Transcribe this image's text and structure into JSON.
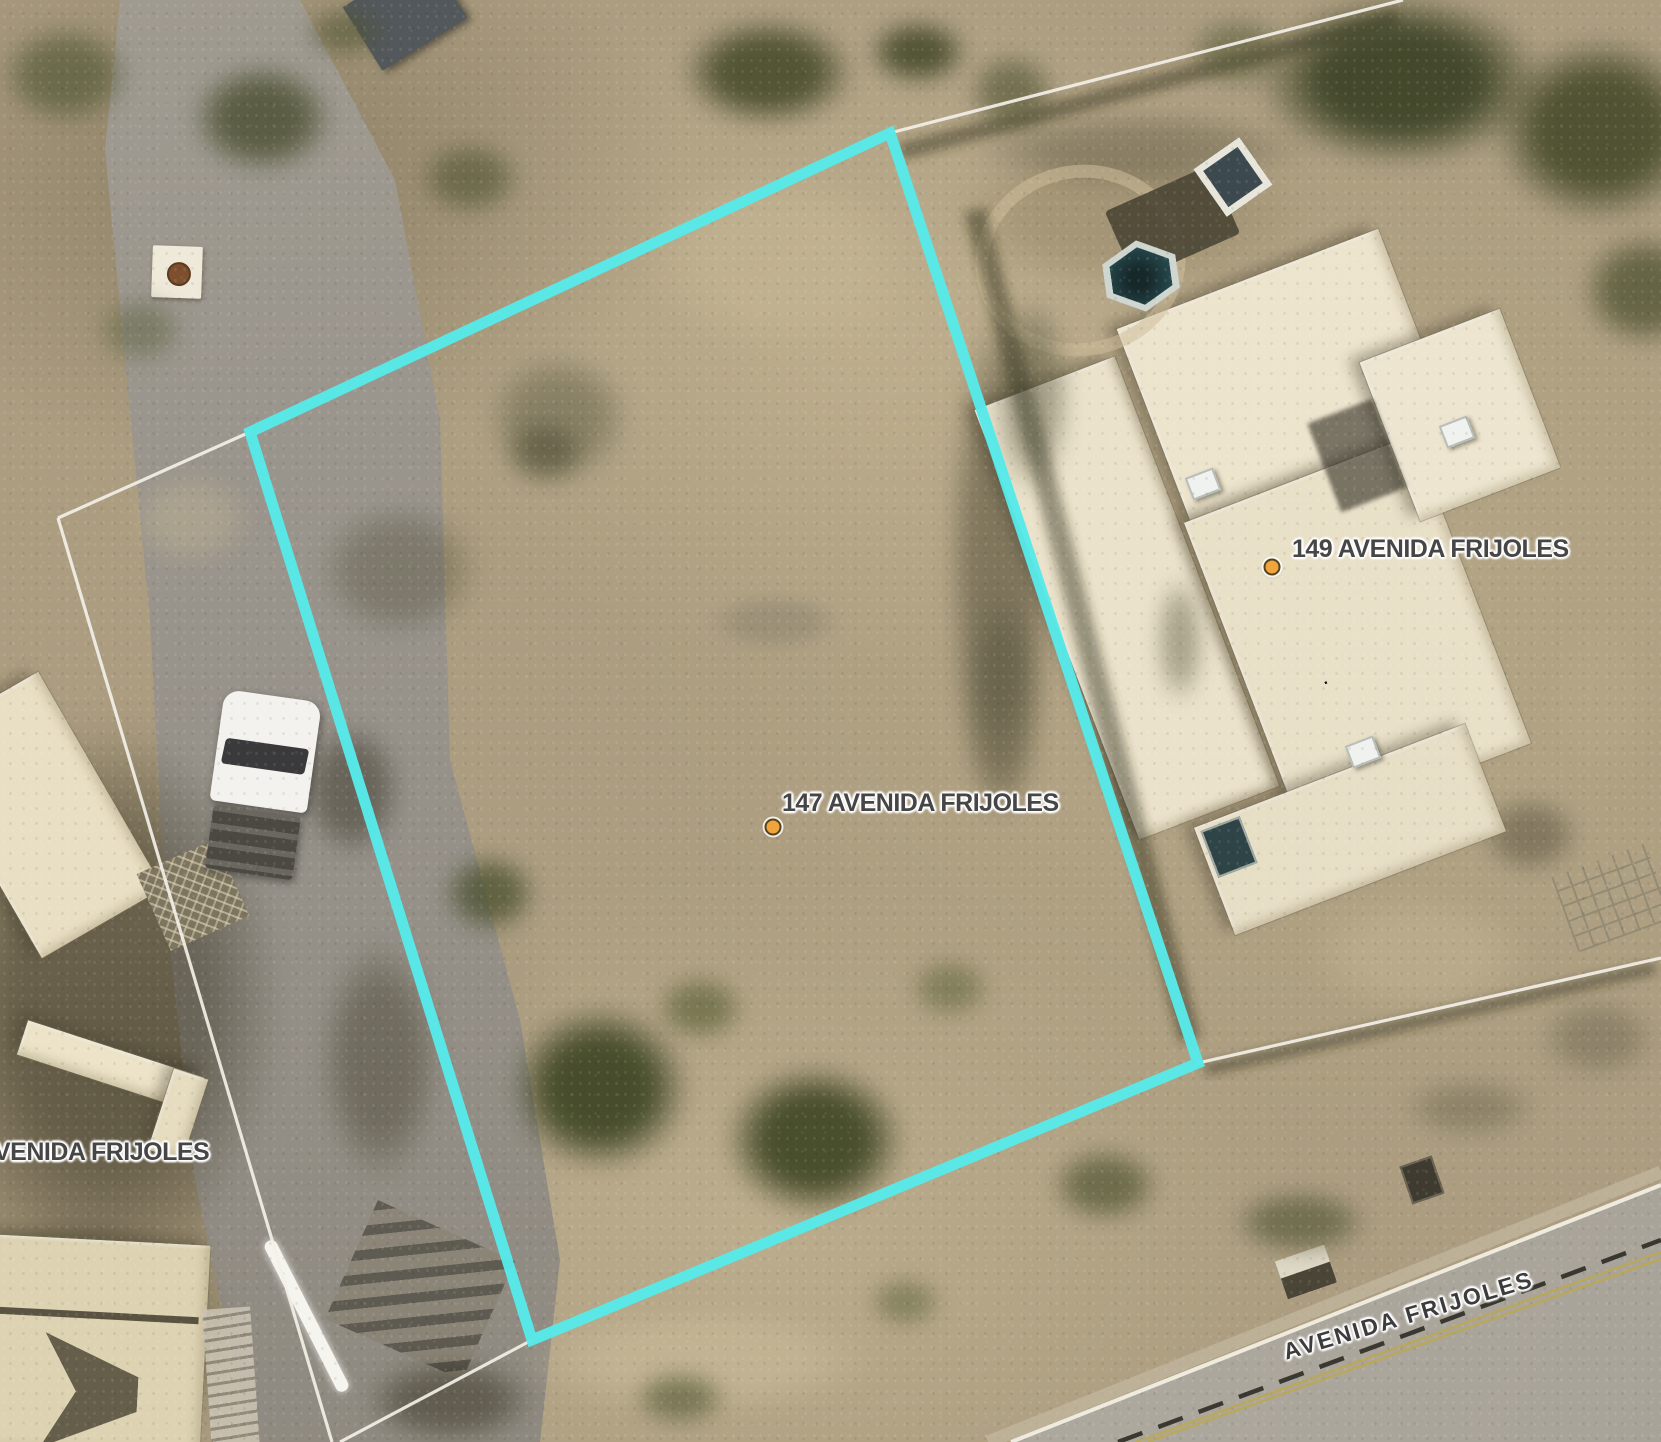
{
  "map": {
    "address_labels": [
      {
        "id": "parcel147",
        "text": "147 AVENIDA FRIJOLES"
      },
      {
        "id": "parcel149",
        "text": "149 AVENIDA FRIJOLES"
      }
    ],
    "street_label": {
      "text": "AVENIDA FRIJOLES"
    },
    "street_label_partial": {
      "text": "VENIDA FRIJOLES"
    }
  },
  "colors": {
    "parcel_highlight": "#57e9e9",
    "parcel_line": "#f3f0e8",
    "label_text": "#464646",
    "street_label_text": "#3c3c3c",
    "label_halo": "#ffffff",
    "marker_fill": "#efa43c",
    "marker_ring": "#55431f",
    "road_dash": "#26241d",
    "road_yellow": "#c1a83e",
    "road_edge_white": "#f2eee2",
    "shoulder": "#c6bda7"
  },
  "geometry": {
    "highlight_polygon": "890,133 250,432 532,1340 1198,1063",
    "parcel_lines": [
      {
        "x1": 890,
        "y1": 133,
        "x2": 1403,
        "y2": 0
      },
      {
        "x1": 250,
        "y1": 432,
        "x2": 58,
        "y2": 518
      },
      {
        "x1": 58,
        "y1": 518,
        "x2": 332,
        "y2": 1442
      },
      {
        "x1": 532,
        "y1": 1340,
        "x2": 340,
        "y2": 1442
      },
      {
        "x1": 1198,
        "y1": 1063,
        "x2": 1661,
        "y2": 958
      }
    ],
    "road_shoulder": {
      "x1": 988,
      "y1": 1442,
      "x2": 1661,
      "y2": 1172
    },
    "road_edge": {
      "x1": 1011,
      "y1": 1442,
      "x2": 1661,
      "y2": 1185
    },
    "road_centerline": {
      "x1": 1118,
      "y1": 1442,
      "x2": 1661,
      "y2": 1240
    },
    "road_yellow_a": {
      "x1": 1136,
      "y1": 1442,
      "x2": 1661,
      "y2": 1252
    },
    "road_yellow_b": {
      "x1": 1148,
      "y1": 1442,
      "x2": 1661,
      "y2": 1259
    },
    "markers": [
      {
        "x": 773,
        "y": 827
      },
      {
        "x": 1272,
        "y": 567
      }
    ]
  },
  "ground_patches": [
    {
      "x": 1130,
      "y": 215,
      "rx": 260,
      "ry": 110,
      "c": "#9a8b6c",
      "o": 0.6
    },
    {
      "x": 780,
      "y": 260,
      "rx": 190,
      "ry": 130,
      "c": "#c6b795",
      "o": 0.55
    },
    {
      "x": 1420,
      "y": 955,
      "rx": 160,
      "ry": 85,
      "c": "#c2b593",
      "o": 0.5
    },
    {
      "x": 700,
      "y": 1360,
      "rx": 250,
      "ry": 75,
      "c": "#cbbd9c",
      "o": 0.55
    },
    {
      "x": 190,
      "y": 520,
      "rx": 85,
      "ry": 65,
      "c": "#c0b291",
      "o": 0.45
    },
    {
      "x": 1240,
      "y": 150,
      "rx": 95,
      "ry": 65,
      "c": "#b3a483",
      "o": 0.55
    },
    {
      "x": 400,
      "y": 570,
      "rx": 115,
      "ry": 95,
      "c": "#55513c",
      "o": 0.4
    },
    {
      "x": 775,
      "y": 622,
      "rx": 95,
      "ry": 40,
      "c": "#8d8570",
      "o": 0.55,
      "b": 6
    },
    {
      "x": 380,
      "y": 1060,
      "rx": 85,
      "ry": 170,
      "c": "#46422f",
      "o": 0.45
    },
    {
      "x": 352,
      "y": 790,
      "rx": 70,
      "ry": 95,
      "c": "#3b382b",
      "o": 0.5
    },
    {
      "x": 110,
      "y": 1000,
      "rx": 240,
      "ry": 380,
      "c": "#403c2b",
      "o": 0.5
    },
    {
      "x": 80,
      "y": 1340,
      "rx": 210,
      "ry": 170,
      "c": "#34311f",
      "o": 0.55
    },
    {
      "x": 1000,
      "y": 560,
      "rx": 75,
      "ry": 360,
      "c": "#4a4733",
      "o": 0.5
    },
    {
      "x": 1470,
      "y": 1108,
      "rx": 95,
      "ry": 42,
      "c": "#6b654f",
      "o": 0.45
    },
    {
      "x": 1530,
      "y": 835,
      "rx": 70,
      "ry": 55,
      "c": "#55503c",
      "o": 0.5
    },
    {
      "x": 1140,
      "y": 150,
      "rx": 240,
      "ry": 55,
      "c": "#5a5340",
      "o": 0.4
    },
    {
      "x": 640,
      "y": 1280,
      "rx": 120,
      "ry": 60,
      "c": "#b6a888",
      "o": 0.45
    },
    {
      "x": 1600,
      "y": 700,
      "rx": 70,
      "ry": 120,
      "c": "#b7a98a",
      "o": 0.4
    },
    {
      "x": 450,
      "y": 1400,
      "rx": 120,
      "ry": 60,
      "c": "#3c3827",
      "o": 0.55
    }
  ],
  "trees": [
    {
      "x": 262,
      "y": 118,
      "rx": 100,
      "ry": 78,
      "c": "#4a4f31",
      "o": 0.8
    },
    {
      "x": 66,
      "y": 75,
      "rx": 92,
      "ry": 70,
      "c": "#565b3a",
      "o": 0.7
    },
    {
      "x": 140,
      "y": 330,
      "rx": 62,
      "ry": 48,
      "c": "#5d6140",
      "o": 0.5
    },
    {
      "x": 470,
      "y": 178,
      "rx": 72,
      "ry": 52,
      "c": "#4e5233",
      "o": 0.6
    },
    {
      "x": 558,
      "y": 418,
      "rx": 102,
      "ry": 92,
      "c": "#6e6b52",
      "o": 0.6
    },
    {
      "x": 545,
      "y": 452,
      "rx": 56,
      "ry": 46,
      "c": "#3e4128",
      "o": 0.45
    },
    {
      "x": 768,
      "y": 72,
      "rx": 122,
      "ry": 76,
      "c": "#434827",
      "o": 0.85
    },
    {
      "x": 918,
      "y": 52,
      "rx": 70,
      "ry": 46,
      "c": "#3c4124",
      "o": 0.8
    },
    {
      "x": 1012,
      "y": 92,
      "rx": 62,
      "ry": 56,
      "c": "#4c5130",
      "o": 0.6
    },
    {
      "x": 1400,
      "y": 80,
      "rx": 200,
      "ry": 120,
      "c": "#3a4124",
      "o": 0.9
    },
    {
      "x": 1600,
      "y": 130,
      "rx": 150,
      "ry": 130,
      "c": "#414626",
      "o": 0.85
    },
    {
      "x": 1645,
      "y": 290,
      "rx": 90,
      "ry": 80,
      "c": "#474c2a",
      "o": 0.7
    },
    {
      "x": 1238,
      "y": 52,
      "rx": 72,
      "ry": 50,
      "c": "#525735",
      "o": 0.55
    },
    {
      "x": 1032,
      "y": 395,
      "rx": 55,
      "ry": 140,
      "c": "#4a4a33",
      "o": 0.45
    },
    {
      "x": 1002,
      "y": 705,
      "rx": 55,
      "ry": 165,
      "c": "#514f38",
      "o": 0.4
    },
    {
      "x": 490,
      "y": 893,
      "rx": 66,
      "ry": 56,
      "c": "#49502e",
      "o": 0.75
    },
    {
      "x": 600,
      "y": 1088,
      "rx": 126,
      "ry": 116,
      "c": "#3c4423",
      "o": 0.9
    },
    {
      "x": 815,
      "y": 1140,
      "rx": 126,
      "ry": 106,
      "c": "#3a421f",
      "o": 0.88
    },
    {
      "x": 700,
      "y": 1008,
      "rx": 62,
      "ry": 46,
      "c": "#4a5229",
      "o": 0.55
    },
    {
      "x": 950,
      "y": 988,
      "rx": 56,
      "ry": 42,
      "c": "#555c35",
      "o": 0.5
    },
    {
      "x": 1105,
      "y": 1185,
      "rx": 76,
      "ry": 52,
      "c": "#494f2c",
      "o": 0.65
    },
    {
      "x": 1300,
      "y": 1222,
      "rx": 96,
      "ry": 46,
      "c": "#42482a",
      "o": 0.55
    },
    {
      "x": 680,
      "y": 1398,
      "rx": 66,
      "ry": 38,
      "c": "#4d5430",
      "o": 0.6
    },
    {
      "x": 905,
      "y": 1302,
      "rx": 52,
      "ry": 36,
      "c": "#565d36",
      "o": 0.5
    },
    {
      "x": 1598,
      "y": 1038,
      "rx": 82,
      "ry": 56,
      "c": "#6f6853",
      "o": 0.5
    },
    {
      "x": 345,
      "y": 32,
      "rx": 56,
      "ry": 36,
      "c": "#4f5434",
      "o": 0.6
    },
    {
      "x": 1180,
      "y": 640,
      "rx": 34,
      "ry": 90,
      "c": "#44432c",
      "o": 0.4
    }
  ]
}
